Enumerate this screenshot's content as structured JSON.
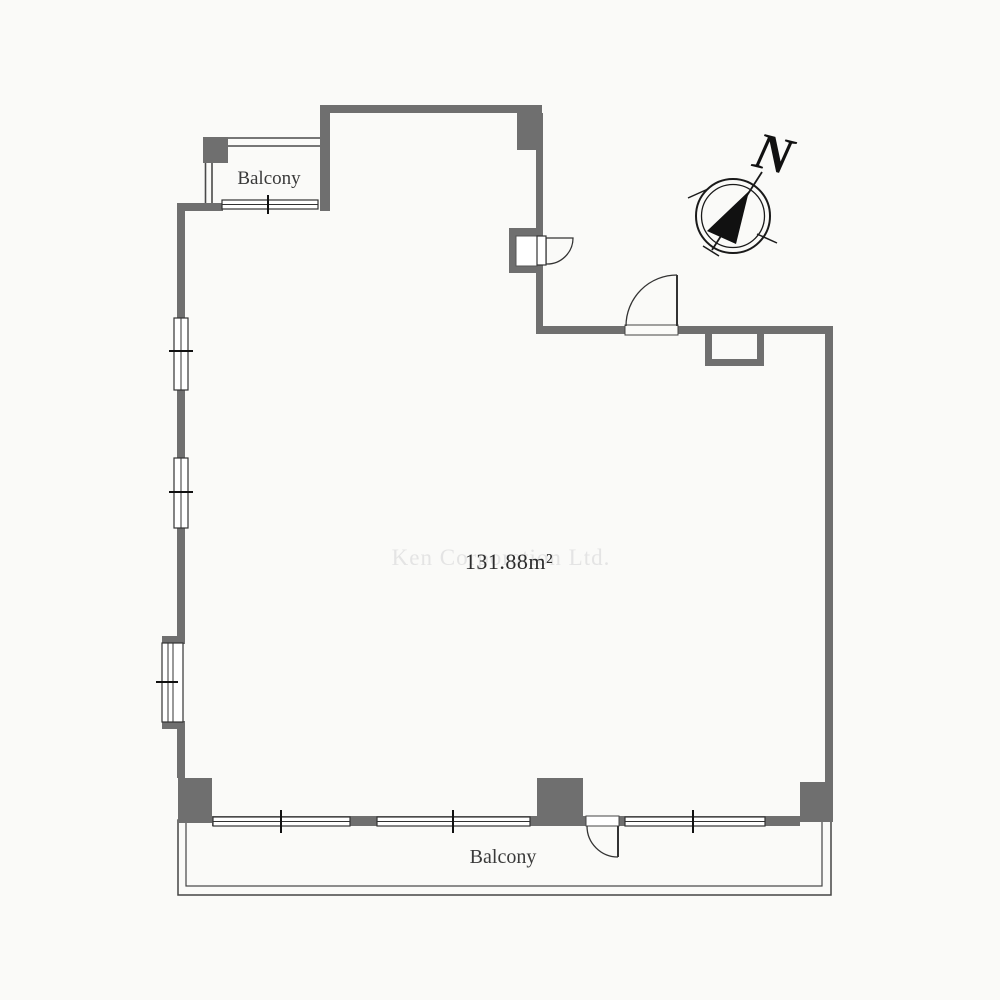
{
  "title": "Apartment floor plan",
  "labels": {
    "balcony_top": "Balcony",
    "balcony_bottom": "Balcony",
    "area": "131.88m²",
    "north": "N",
    "watermark": "Ken Corporation Ltd."
  },
  "area_m2": 131.88,
  "compass": {
    "direction": "north-east"
  },
  "colors": {
    "background": "#fafaf8",
    "wall": "#6f6f6f",
    "outline": "#333333",
    "railing": "#4a4a4a",
    "tick": "#111111",
    "label_text": "#3a3a3a",
    "area_text": "#2d2d2d",
    "watermark": "#e4e4e4",
    "compass": "#1a1a1a"
  }
}
